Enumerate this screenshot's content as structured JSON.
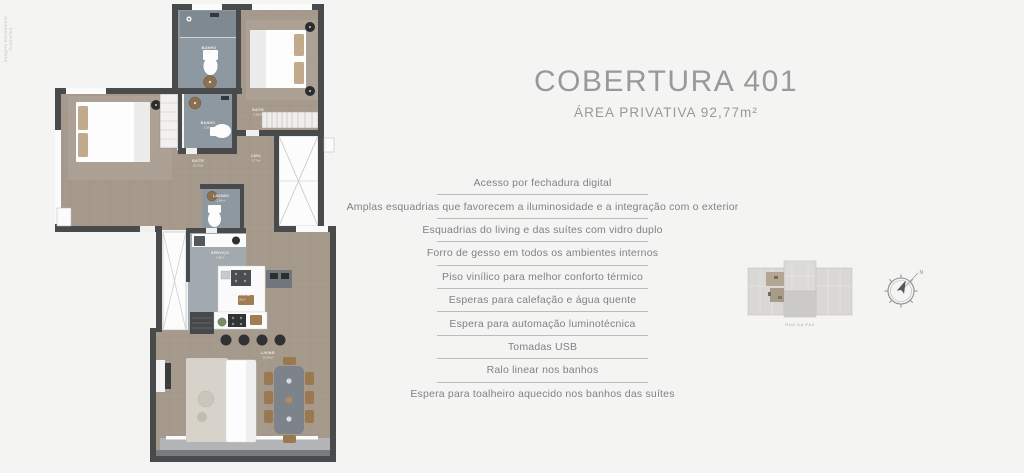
{
  "disclaimer": "Imagem meramente ilustrativa",
  "header": {
    "title": "COBERTURA 401",
    "subtitle": "ÁREA PRIVATIVA  92,77m²"
  },
  "features": [
    "Acesso por fechadura digital",
    "Amplas esquadrias que favorecem a iluminosidade e a integração com o exterior",
    "Esquadrias do living e das suítes com vidro duplo",
    "Forro de gesso em todos os ambientes internos",
    "Piso vinílico para melhor conforto térmico",
    "Esperas para calefação e água quente",
    "Espera para automação luminotécnica",
    "Tomadas USB",
    "Ralo linear nos banhos",
    "Espera para toalheiro aquecido nos banhos das suítes"
  ],
  "floorplan": {
    "rooms": [
      {
        "label": "BANHO",
        "area": "1,98m²"
      },
      {
        "label": "SUÍTE",
        "area": "9,86m²"
      },
      {
        "label": "BANHO",
        "area": "2,28m²"
      },
      {
        "label": "SUÍTE",
        "area": "15,75m²"
      },
      {
        "label": "CIRC",
        "area": "2,77m²"
      },
      {
        "label": "LAVABO",
        "area": "1,86m²"
      },
      {
        "label": "SERVIÇO",
        "area": "3,86m²"
      },
      {
        "label": "COZINHA",
        "area": "7,36m²"
      },
      {
        "label": "LIVING",
        "area": "20,94m²"
      }
    ]
  },
  "siteplan": {
    "street_label": "RUA DA PAZ"
  },
  "compass": {
    "north_label": "N"
  },
  "colors": {
    "background": "#f4f4f3",
    "wall": "#494a4c",
    "wood_floor": "#a69a8d",
    "bath_floor": "#8d98a1",
    "gray_floor": "#a2a9af",
    "text_accent": "#97999b",
    "feature_text": "#7e8287",
    "divider": "#bcbcbc"
  }
}
